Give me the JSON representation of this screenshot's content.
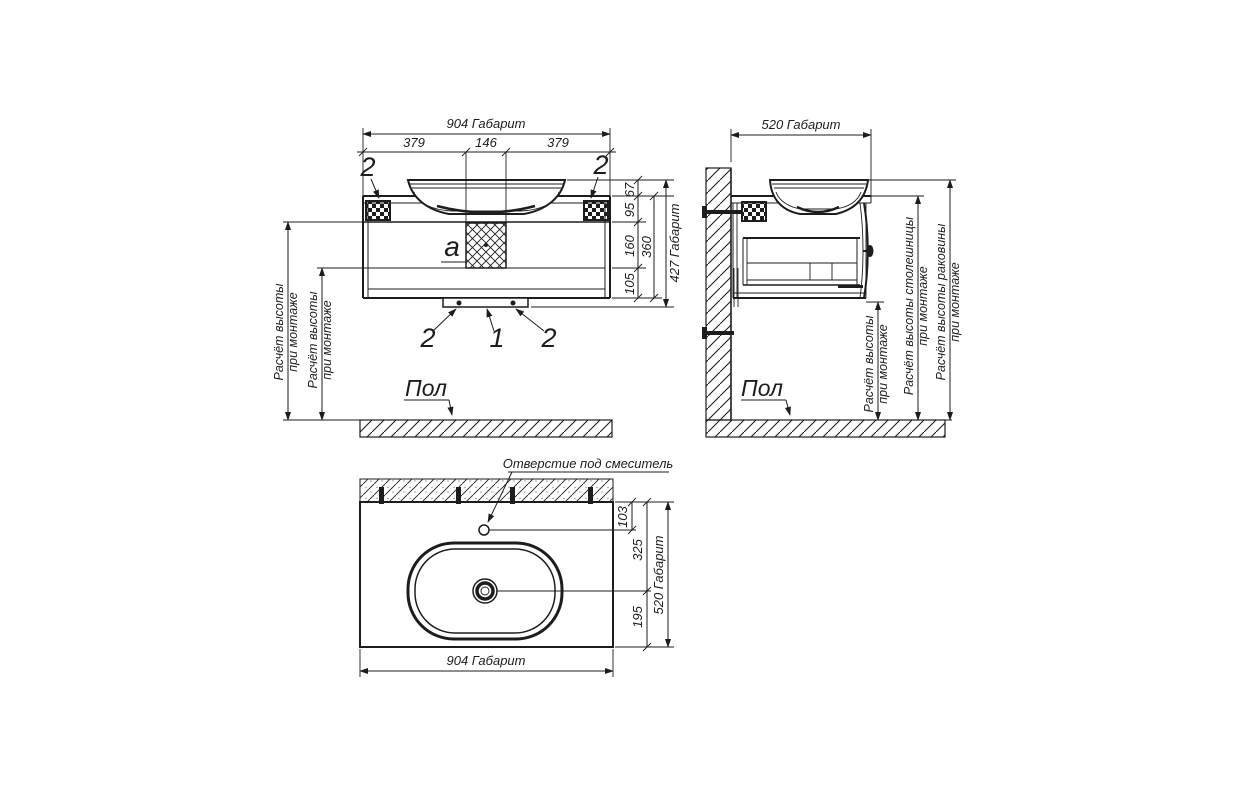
{
  "meta": {
    "background_color": "#ffffff",
    "ink_color": "#1d1d1d",
    "drawing_type": "vanity-cabinet-installation-drawing"
  },
  "front": {
    "dim_overall_width": "904 Габарит",
    "dim_left": "379",
    "dim_center": "146",
    "dim_right": "379",
    "dim_h67": "67",
    "dim_h95": "95",
    "dim_h160": "160",
    "dim_h360": "360",
    "dim_h105": "105",
    "dim_overall_height": "427 Габарит",
    "callout_bracket_left": "2",
    "callout_bracket_right": "2",
    "callout_rail_left": "2",
    "callout_drain": "1",
    "callout_rail_right": "2",
    "callout_detail": "a",
    "height_note_line1": "Расчёт высоты",
    "height_note_line2": "при монтаже",
    "floor_label": "Пол"
  },
  "side": {
    "dim_overall_depth": "520 Габарит",
    "note_height_line1": "Расчёт высоты",
    "note_height_line2": "при монтаже",
    "note_countertop_line1": "Расчёт высоты столешницы",
    "note_countertop_line2": "при монтаже",
    "note_basin_line1": "Расчёт высоты раковины",
    "note_basin_line2": "при монтаже",
    "floor_label": "Пол"
  },
  "plan": {
    "faucet_hole_label": "Отверстие под смеситель",
    "dim_hole_offset": "103",
    "dim_drain_offset": "325",
    "dim_drain_to_front": "195",
    "dim_overall_depth": "520 Габарит",
    "dim_overall_width": "904 Габарит"
  }
}
